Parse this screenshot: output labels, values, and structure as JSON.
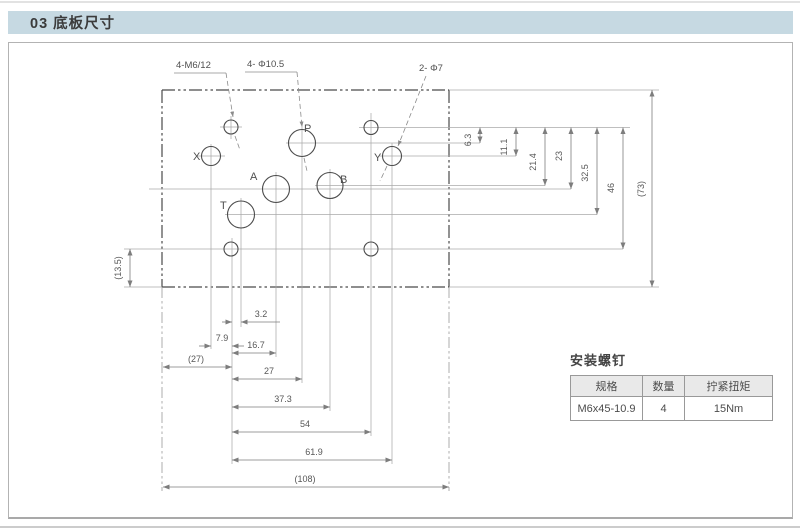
{
  "header": {
    "title": "03 底板尺寸"
  },
  "colors": {
    "title_bar_bg": "#c6d9e2",
    "table_header_bg": "#e9e9e9",
    "plate_line": "#4a4a4a",
    "dim_line": "#7d7d7d"
  },
  "drawing": {
    "callouts": {
      "mounting_holes": "4-M6/12",
      "main_ports": "4- Φ10.5",
      "pilot_ports": "2- Φ7"
    },
    "ports": {
      "x": "X",
      "p": "P",
      "y": "Y",
      "a": "A",
      "b": "B",
      "t": "T"
    },
    "dims": {
      "v": [
        "6.3",
        "11.1",
        "21.4",
        "23",
        "32.5",
        "46",
        "(73)"
      ],
      "h": [
        "3.2",
        "7.9",
        "16.7",
        "(27)",
        "27",
        "37.3",
        "54",
        "61.9",
        "(108)"
      ],
      "left": "(13.5)"
    }
  },
  "screw_table": {
    "title": "安装螺钉",
    "headers": [
      "规格",
      "数量",
      "拧紧扭矩"
    ],
    "row": [
      "M6x45-10.9",
      "4",
      "15Nm"
    ]
  }
}
